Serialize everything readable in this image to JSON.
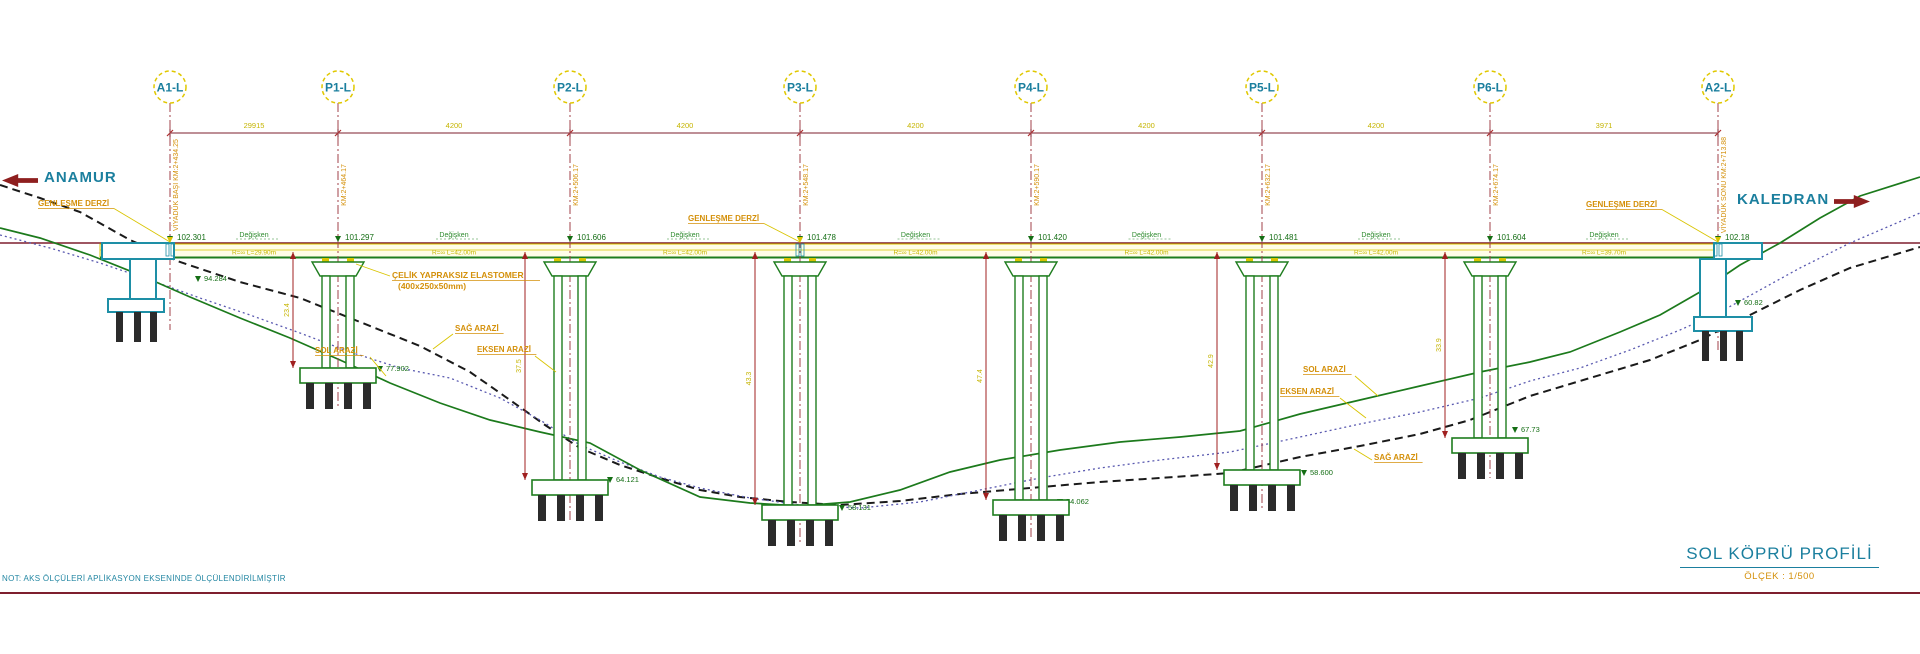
{
  "drawing": {
    "title": "SOL KÖPRÜ PROFİLİ",
    "scale_label": "ÖLÇEK : 1/500",
    "left_destination": "ANAMUR",
    "right_destination": "KALEDRAN",
    "bottom_note": "NOT: AKS ÖLÇÜLERİ APLİKASYON EKSENİNDE ÖLÇÜLENDİRİLMİŞTİR",
    "expansion_joint_label": "GENLEŞME DERZİ",
    "bearing_label_line1": "ÇELİK YAPRAKSIZ ELASTOMER",
    "bearing_label_line2": "(400x250x50mm)",
    "deck_slope_label": "Değişken",
    "colors": {
      "teal": "#1b7f9e",
      "abutment": "#1e8fa6",
      "orange": "#d4900a",
      "yellow": "#d9c400",
      "yellow_text": "#c5b400",
      "darkred": "#7e1f2e",
      "arrow_red": "#8e1f1f",
      "green_structure": "#1e7d1e",
      "green_text": "#156e15",
      "terrain_green": "#1c7a1c",
      "terrain_blue": "#5a5ab0",
      "terrain_black": "#1a1a1a",
      "deck_fill": "#fffde8"
    }
  },
  "axes": [
    {
      "id": "A1-L",
      "x": 170,
      "type": "abutment",
      "deck_elevation": "102.301",
      "foundation_elevation": "94.284",
      "foundation_label_pos": [
        202,
        282
      ],
      "vertical_note": "VİYADÜK BAŞI KM:2+434.25"
    },
    {
      "id": "P1-L",
      "x": 338,
      "type": "pier",
      "deck_elevation": "101.297",
      "foundation_elevation": "77.902",
      "foundation_label_pos": [
        384,
        372
      ],
      "vertical_note": "KM:2+464.17",
      "footing_y": 368,
      "height_dim": "23.4"
    },
    {
      "id": "P2-L",
      "x": 570,
      "type": "pier",
      "deck_elevation": "101.606",
      "foundation_elevation": "64.121",
      "foundation_label_pos": [
        614,
        483
      ],
      "vertical_note": "KM:2+506.17",
      "footing_y": 480,
      "height_dim": "37.5"
    },
    {
      "id": "P3-L",
      "x": 800,
      "type": "pier",
      "deck_elevation": "101.478",
      "foundation_elevation": "58.131",
      "foundation_label_pos": [
        846,
        511
      ],
      "vertical_note": "KM:2+548.17",
      "footing_y": 505,
      "height_dim": "43.3"
    },
    {
      "id": "P4-L",
      "x": 1031,
      "type": "pier",
      "deck_elevation": "101.420",
      "foundation_elevation": "54.062",
      "foundation_label_pos": [
        1064,
        505
      ],
      "vertical_note": "KM:2+590.17",
      "footing_y": 500,
      "height_dim": "47.4"
    },
    {
      "id": "P5-L",
      "x": 1262,
      "type": "pier",
      "deck_elevation": "101.481",
      "foundation_elevation": "58.600",
      "foundation_label_pos": [
        1308,
        476
      ],
      "vertical_note": "KM:2+632.17",
      "footing_y": 470,
      "height_dim": "42.9"
    },
    {
      "id": "P6-L",
      "x": 1490,
      "type": "pier",
      "deck_elevation": "101.604",
      "foundation_elevation": "67.73",
      "foundation_label_pos": [
        1519,
        433
      ],
      "vertical_note": "KM:2+674.17",
      "footing_y": 438,
      "height_dim": "33.9"
    },
    {
      "id": "A2-L",
      "x": 1718,
      "type": "abutment",
      "deck_elevation": "102.18",
      "foundation_elevation": "60.82",
      "foundation_label_pos": [
        1742,
        306
      ],
      "vertical_note": "VİYADÜK SONU KM:2+713.88"
    }
  ],
  "span_dimensions": [
    "29915",
    "4200",
    "4200",
    "4200",
    "4200",
    "4200",
    "3971"
  ],
  "span_deck_labels": [
    "R=∞ L=29.90m",
    "R=∞ L=42.00m",
    "R=∞ L=42.00m",
    "R=∞ L=42.00m",
    "R=∞ L=42.00m",
    "R=∞ L=42.00m",
    "R=∞ L=39.70m"
  ],
  "expansion_joints": [
    {
      "x": 38,
      "y": 206,
      "axis_x": 170
    },
    {
      "x": 688,
      "y": 221,
      "axis_x": 800
    },
    {
      "x": 1586,
      "y": 207,
      "axis_x": 1718
    }
  ],
  "bearing_note": {
    "x": 392,
    "y": 278,
    "leader_to": [
      356,
      264
    ]
  },
  "terrain": {
    "left_labels": [
      {
        "text": "SAĞ ARAZİ",
        "x": 455,
        "y": 331,
        "lead": [
          453,
          334,
          433,
          349
        ]
      },
      {
        "text": "EKSEN ARAZİ",
        "x": 477,
        "y": 352,
        "lead": [
          535,
          356,
          556,
          372
        ]
      },
      {
        "text": "SOL ARAZİ",
        "x": 315,
        "y": 353,
        "lead": [
          370,
          357,
          386,
          376
        ]
      }
    ],
    "right_labels": [
      {
        "text": "SOL ARAZİ",
        "x": 1303,
        "y": 372,
        "lead": [
          1355,
          376,
          1378,
          396
        ]
      },
      {
        "text": "EKSEN ARAZİ",
        "x": 1280,
        "y": 394,
        "lead": [
          1340,
          398,
          1366,
          418
        ]
      },
      {
        "text": "SAĞ ARAZİ",
        "x": 1374,
        "y": 460,
        "lead": [
          1372,
          460,
          1354,
          449
        ]
      }
    ],
    "lines": {
      "sol_green": [
        [
          0,
          228
        ],
        [
          40,
          238
        ],
        [
          90,
          255
        ],
        [
          140,
          275
        ],
        [
          190,
          297
        ],
        [
          240,
          318
        ],
        [
          290,
          338
        ],
        [
          340,
          360
        ],
        [
          390,
          383
        ],
        [
          440,
          403
        ],
        [
          490,
          420
        ],
        [
          540,
          432
        ],
        [
          590,
          443
        ],
        [
          640,
          470
        ],
        [
          700,
          497
        ],
        [
          750,
          503
        ],
        [
          800,
          506
        ],
        [
          850,
          502
        ],
        [
          900,
          490
        ],
        [
          950,
          472
        ],
        [
          1000,
          460
        ],
        [
          1060,
          450
        ],
        [
          1120,
          442
        ],
        [
          1180,
          437
        ],
        [
          1240,
          431
        ],
        [
          1300,
          414
        ],
        [
          1360,
          400
        ],
        [
          1420,
          386
        ],
        [
          1480,
          372
        ],
        [
          1530,
          362
        ],
        [
          1570,
          352
        ],
        [
          1620,
          332
        ],
        [
          1660,
          315
        ],
        [
          1700,
          292
        ],
        [
          1740,
          265
        ],
        [
          1780,
          243
        ],
        [
          1820,
          218
        ],
        [
          1860,
          196
        ],
        [
          1920,
          177
        ]
      ],
      "eksen_blue": [
        [
          0,
          235
        ],
        [
          50,
          248
        ],
        [
          100,
          263
        ],
        [
          150,
          280
        ],
        [
          200,
          298
        ],
        [
          250,
          315
        ],
        [
          300,
          333
        ],
        [
          350,
          352
        ],
        [
          400,
          368
        ],
        [
          450,
          378
        ],
        [
          500,
          398
        ],
        [
          540,
          420
        ],
        [
          580,
          445
        ],
        [
          620,
          462
        ],
        [
          660,
          477
        ],
        [
          700,
          488
        ],
        [
          750,
          498
        ],
        [
          800,
          505
        ],
        [
          860,
          508
        ],
        [
          920,
          502
        ],
        [
          980,
          490
        ],
        [
          1040,
          478
        ],
        [
          1100,
          468
        ],
        [
          1160,
          460
        ],
        [
          1230,
          452
        ],
        [
          1300,
          437
        ],
        [
          1360,
          424
        ],
        [
          1420,
          412
        ],
        [
          1480,
          398
        ],
        [
          1530,
          381
        ],
        [
          1580,
          368
        ],
        [
          1630,
          350
        ],
        [
          1680,
          330
        ],
        [
          1720,
          312
        ],
        [
          1760,
          290
        ],
        [
          1800,
          268
        ],
        [
          1850,
          243
        ],
        [
          1920,
          213
        ]
      ],
      "sag_black": [
        [
          0,
          185
        ],
        [
          40,
          198
        ],
        [
          80,
          212
        ],
        [
          130,
          240
        ],
        [
          180,
          262
        ],
        [
          240,
          282
        ],
        [
          300,
          298
        ],
        [
          360,
          322
        ],
        [
          420,
          346
        ],
        [
          470,
          372
        ],
        [
          510,
          400
        ],
        [
          545,
          425
        ],
        [
          580,
          448
        ],
        [
          620,
          465
        ],
        [
          660,
          478
        ],
        [
          700,
          490
        ],
        [
          740,
          497
        ],
        [
          790,
          502
        ],
        [
          840,
          505
        ],
        [
          900,
          501
        ],
        [
          960,
          494
        ],
        [
          1030,
          488
        ],
        [
          1100,
          482
        ],
        [
          1160,
          478
        ],
        [
          1230,
          473
        ],
        [
          1300,
          457
        ],
        [
          1360,
          446
        ],
        [
          1420,
          434
        ],
        [
          1470,
          420
        ],
        [
          1530,
          396
        ],
        [
          1590,
          378
        ],
        [
          1650,
          360
        ],
        [
          1700,
          340
        ],
        [
          1750,
          315
        ],
        [
          1800,
          290
        ],
        [
          1850,
          268
        ],
        [
          1920,
          247
        ]
      ]
    }
  }
}
